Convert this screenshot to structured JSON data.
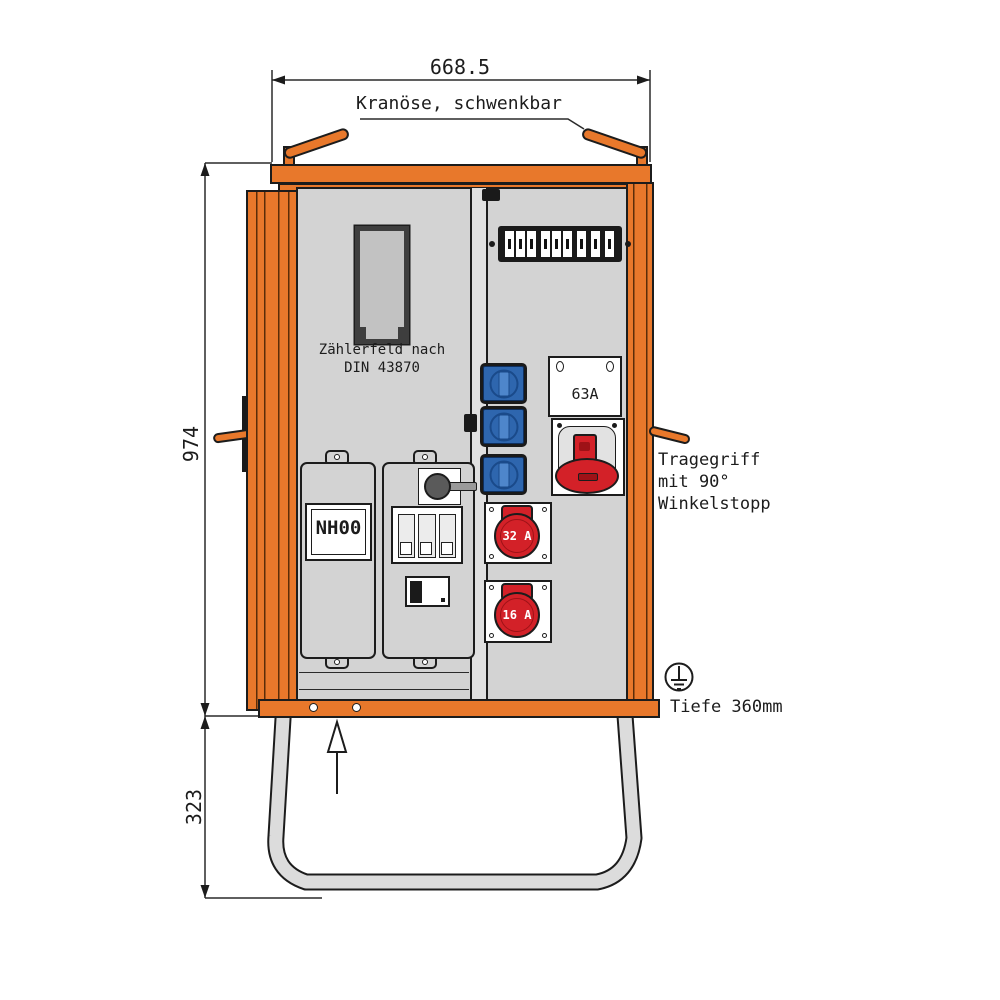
{
  "colors": {
    "orange": "#E8782B",
    "line": "#1C1C1C",
    "dark": "#1A1A1A",
    "panel": "#D3D3D3",
    "panelLight": "#E0E0E0",
    "meterGlass": "#C2C2C2",
    "meterFrame": "#3E3E3E",
    "white": "#FFFFFF",
    "blue": "#2E66AE",
    "blueDark": "#1A4A8A",
    "red": "#D32128",
    "redDark": "#9E1217",
    "tube": "#DCDCDC"
  },
  "dimensions": {
    "top_width": "668.5",
    "height_upper": "974",
    "height_lower": "323"
  },
  "annotations": {
    "crane": "Kranöse, schwenkbar",
    "handle_l1": "Tragegriff",
    "handle_l2": "mit 90°",
    "handle_l3": "Winkelstopp",
    "depth": "Tiefe 360mm"
  },
  "cabinet": {
    "meter_l1": "Zählerfeld nach",
    "meter_l2": "DIN 43870",
    "fuse_label": "NH00",
    "outlet63_label": "63A",
    "outlet32_label": "32 A",
    "outlet16_label": "16 A"
  }
}
